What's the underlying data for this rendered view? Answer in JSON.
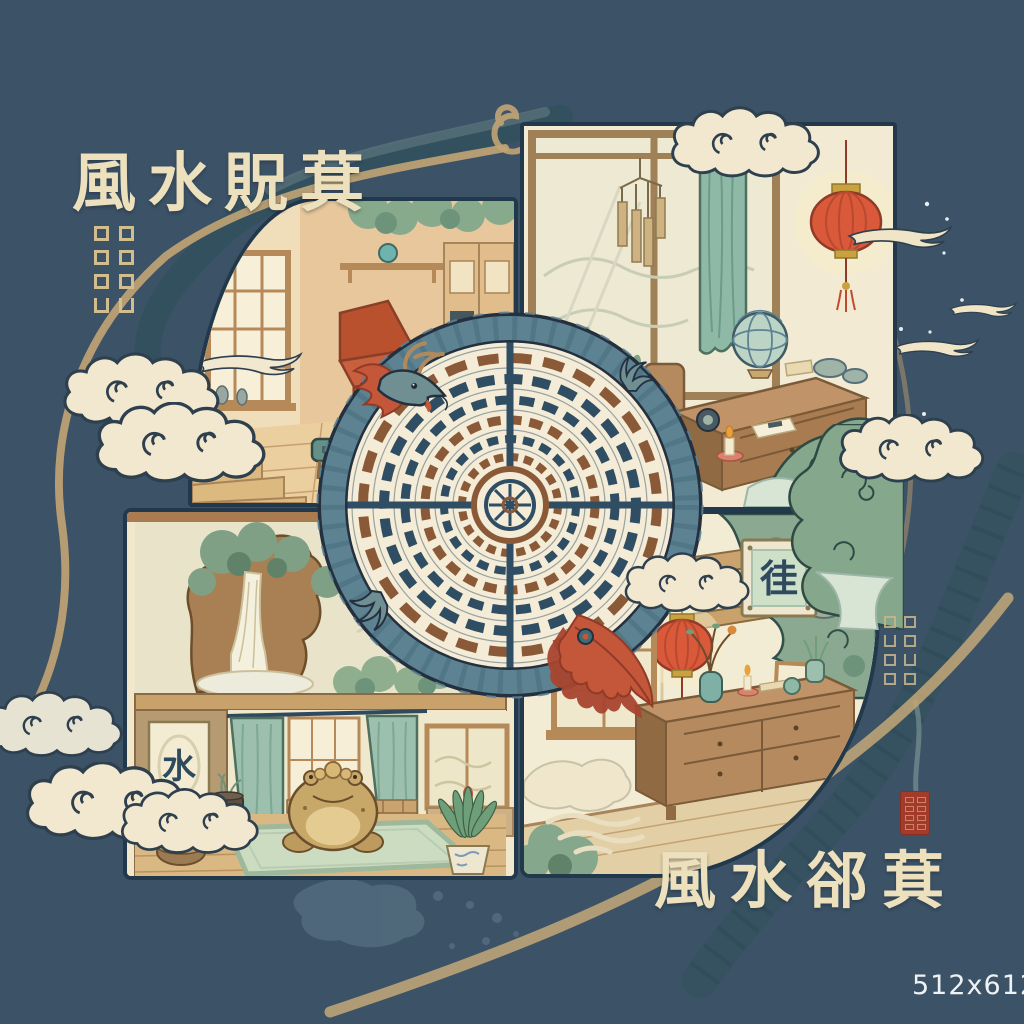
{
  "titles": {
    "top_left": "風水貺萁",
    "bottom_right": "風水郤萁"
  },
  "watermark": "512x612",
  "panels": {
    "top_left": {
      "name": "warm-living-room-scene"
    },
    "top_right": {
      "name": "study-room-scene"
    },
    "bottom_left": {
      "name": "garden-waterfall-and-tea-room-scene",
      "scroll_character": "水"
    },
    "bottom_right": {
      "name": "hallway-scene",
      "plaque_character": "徍"
    }
  },
  "center": {
    "name": "dragon-coiled-around-bagua-compass"
  },
  "colors": {
    "background": "#3c5266",
    "ink_outline": "#24394a",
    "panel_cream": "#f2ead3",
    "gold_swirl": "#c2a474",
    "lantern_red": "#d9593a",
    "dragon_teal": "#5d8292",
    "plume_red": "#c4563a",
    "leaf_green": "#85a78b",
    "curtain_teal": "#93bba9",
    "wood_tan": "#c09468",
    "seal_red": "#a33b2a",
    "title_cream": "#ece0bd",
    "watermark_white": "#eef2f5"
  }
}
